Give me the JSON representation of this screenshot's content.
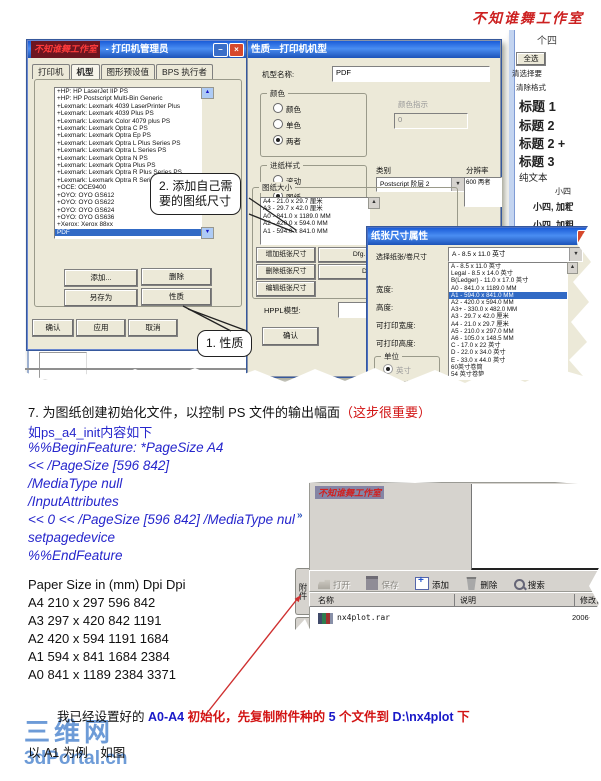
{
  "icons": {
    "close": "×",
    "minimize": "–",
    "dropdown": "▼",
    "scroll_up": "▲",
    "scroll_down": "▼",
    "chevron": "»"
  },
  "page": {
    "top_watermark": "不知谁舞工作室"
  },
  "shot1": {
    "dialog1": {
      "watermark": "不知谁舞工作室",
      "title": "- 打印机管理员",
      "tabs": [
        "打印机",
        "机型",
        "图形预设值",
        "BPS 执行者"
      ],
      "tabs_active": 1,
      "printers": [
        "+HP: HP LaserJet IIP PS",
        "+HP: HP Postscript Multi-Bin Generic",
        "+Lexmark: Lexmark 4039 LaserPrinter Plus",
        "+Lexmark: Lexmark 4039 Plus PS",
        "+Lexmark: Lexmark Color 4079 plus PS",
        "+Lexmark: Lexmark Optra C PS",
        "+Lexmark: Lexmark Optra Ep PS",
        "+Lexmark: Lexmark Optra L Plus Series PS",
        "+Lexmark: Lexmark Optra L Series PS",
        "+Lexmark: Lexmark Optra N PS",
        "+Lexmark: Lexmark Optra Plus PS",
        "+Lexmark: Lexmark Optra R Plus Series PS",
        "+Lexmark: Lexmark Optra R Series PS",
        "+OCE: OCE9400",
        "+OYO: OYO GS612",
        "+OYO: OYO GS622",
        "+OYO: OYO GS624",
        "+OYO: OYO GS636",
        "+Xerox: Xerox 88xx",
        "PDF"
      ],
      "printers_selected": 19,
      "btn_add": "添加...",
      "btn_delete": "删除",
      "btn_save_as": "另存为",
      "btn_props": "性质",
      "btn_ok": "确认",
      "btn_apply": "应用",
      "btn_cancel": "取消"
    },
    "callout1": "1. 性质",
    "callout2_line1": "2. 添加自己需",
    "callout2_line2": "要的图纸尺寸",
    "dialog2": {
      "title": "性质—打印机机型",
      "model_label": "机型名称:",
      "model_value": "PDF",
      "color_label": "颜色",
      "color_opt1": "颜色",
      "color_opt2": "单色",
      "color_opt3": "两者",
      "indicator_label": "颜色指示",
      "indicator_value": "0",
      "feed_label": "进纸样式",
      "feed_opt1": "滚动",
      "feed_opt2": "图纸",
      "feed_opt3": "两者",
      "category_label": "类别",
      "category_value": "Postscript 阶层 2",
      "resolution_label": "分辨率",
      "resolution_value": "600 两者",
      "paper_label": "图纸大小",
      "paper_sizes": [
        "A4 - 21.0 x 29.7 厘米",
        "A3 - 29.7 x 42.0 厘米",
        "A0 - 841.0 x 1189.0 MM",
        "A2 - 420.0 x 594.0 MM",
        "A1 - 594.0 x 841.0 MM"
      ],
      "btn_add_size": "增加纸张尺寸",
      "btn_del_size": "删除纸张尺寸",
      "btn_edit_size": "编辑纸张尺寸",
      "btn_dfg1": "Dfg. 36英寸 宽",
      "btn_dfg2": "Dfg 小于",
      "hppl_label": "HPPL模型:",
      "btn_ok": "确认"
    },
    "dialog3": {
      "title": "纸张尺寸属性",
      "select_label": "选择纸张/卷尺寸",
      "combo_value": "A - 8.5 x 11.0 英寸",
      "options": [
        "A - 8.5 x 11.0 英寸",
        "Legal - 8.5 x 14.0 英寸",
        "B(Ledger) - 11.0 x 17.0 英寸",
        "A0 - 841.0 x 1189.0 MM",
        "A1 - 594.0 x 841.0 MM",
        "A2 - 420.0 x 594.0 MM",
        "A3+ - 330.0 x 482.0 MM",
        "A3 - 29.7 x 42.0 厘米",
        "A4 - 21.0 x 29.7 厘米",
        "A5 - 210.0 x 297.0 MM",
        "A6 - 105.0 x 148.5 MM",
        "C - 17.0 x 22 英寸",
        "D - 22.0 x 34.0 英寸",
        "E - 33.0 x 44.0 英寸",
        "60英寸卷筒",
        "54 英寸卷筒"
      ],
      "options_selected": 4,
      "width_label": "宽度:",
      "height_label": "高度:",
      "pw_label": "可打印宽度:",
      "ph_label": "可打印高度:",
      "unit_label": "单位",
      "unit_inch": "英寸",
      "unit_mm": "毫米"
    },
    "styles_panel": {
      "partial_top": "个四",
      "select_all": "全选",
      "item_small1": "清选择要",
      "item_small2": "清除格式",
      "h1": "标题 1",
      "h2": "标题 2",
      "h2plus": "标题 2 +",
      "h3": "标题 3",
      "plain": "纯文本",
      "s1": "小四",
      "s2": "小四, 加粗",
      "s3": "小四, 加粗"
    }
  },
  "step7": {
    "black": "7.  为图纸创建初始化文件，以控制 PS 文件的输出幅面",
    "red": "（这步很重要）",
    "intro": "如ps_a4_init内容如下",
    "code_lines": [
      "%%BeginFeature: *PageSize A4",
      "<< /PageSize [596 842]",
      "/MediaType null",
      "/InputAttributes",
      "<< 0 << /PageSize [596 842] /MediaType null >> >>",
      "setpagedevice",
      "%%EndFeature"
    ]
  },
  "paper_table": {
    "header": "Paper Size in (mm) Dpi Dpi",
    "rows": [
      "A4 210 x 297 596 842",
      "A3 297 x 420 842 1191",
      "A2 420 x 594 1191 1684",
      "A1 594 x 841 1684 2384",
      "A0 841 x 1189 2384 3371"
    ]
  },
  "shot2": {
    "watermark": "不知谁舞工作室",
    "tab1": "附件",
    "tab2": "附件",
    "toolbar": {
      "open": "打开",
      "save": "保存",
      "add": "添加",
      "del": "删除",
      "search": "搜索"
    },
    "col_name": "名称",
    "col_desc": "说明",
    "col_date": "修改日期",
    "file_name": "nx4plot.rar",
    "file_date": "2006-12"
  },
  "bottom": {
    "s1": "我已经设置好的 ",
    "s2": "A0-A4 ",
    "s3": "初始化，先复制附件种的 ",
    "s4": "5 ",
    "s5": "个文件到 ",
    "s6": "D:\\nx4plot ",
    "s7": "下",
    "example": "以 A1 为例　如图",
    "logo_cn": "三维网",
    "logo_en": "3dPortal.cn"
  }
}
